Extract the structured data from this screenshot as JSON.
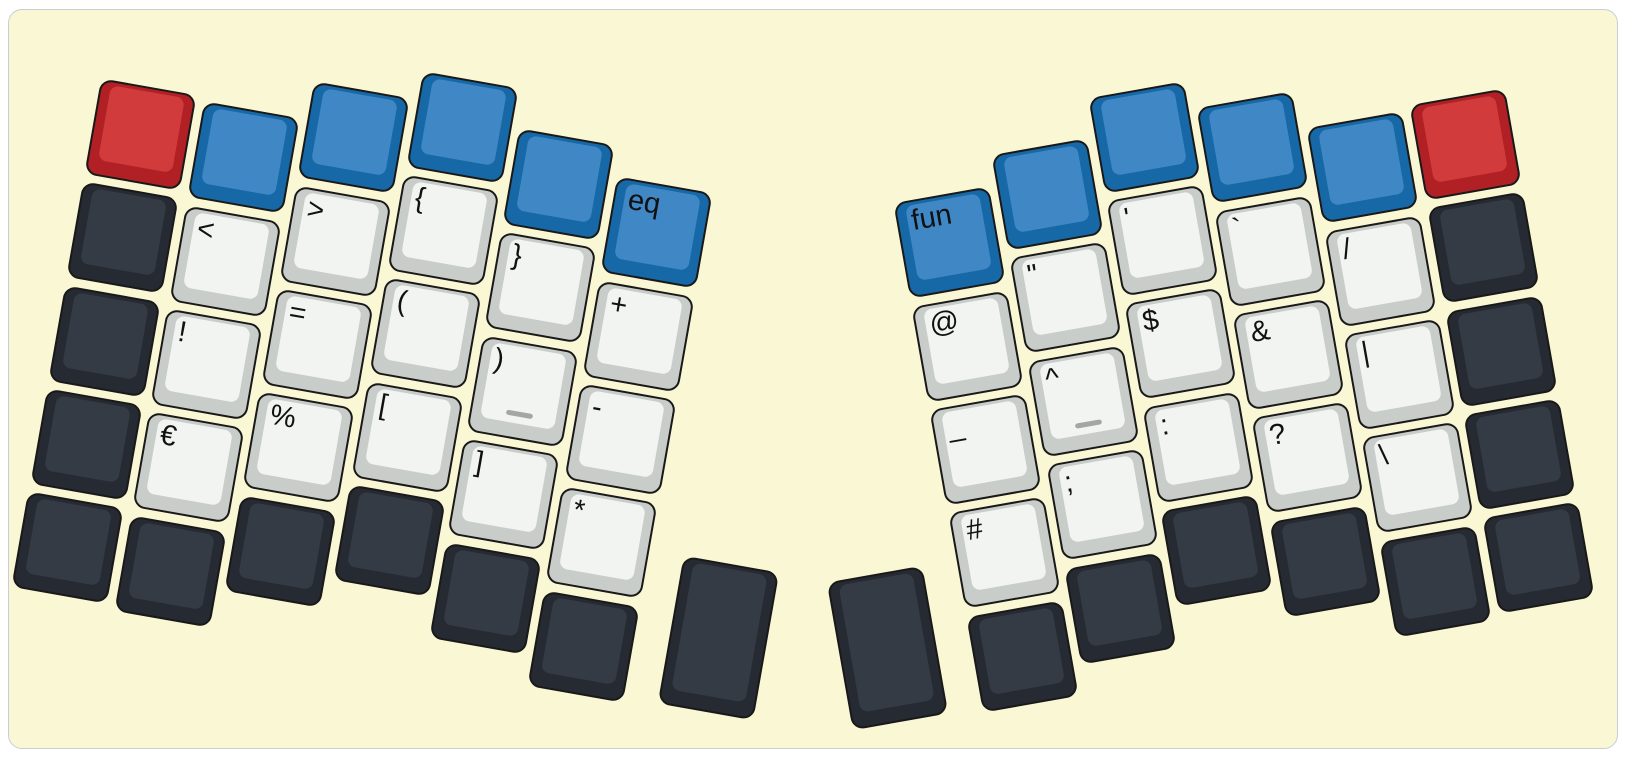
{
  "page": {
    "background": "#FFFFFF"
  },
  "panel": {
    "background": "#FAF7D4",
    "border_color": "#C7CED6"
  },
  "key_colors": {
    "red": {
      "base": "#B02025",
      "top": "#D23B3B"
    },
    "blue": {
      "base": "#1768A7",
      "top": "#3F87C5"
    },
    "dark": {
      "base": "#262A32",
      "top": "#353B45"
    },
    "light": {
      "base": "#C9CDC9",
      "top": "#F1F4F0"
    }
  },
  "outline_color": "#191919",
  "legend_color": "#111111",
  "homing_bar_color": "#A2A7A1",
  "geometry": {
    "pitch": 105,
    "key_size": 97,
    "legend_font_size": 29
  },
  "halves": [
    {
      "name": "left-half",
      "angle": 10,
      "origin": [
        462,
        127
      ],
      "anchor_col": 3,
      "staggers": [
        0.6,
        0.65,
        0.28,
        0,
        0.38,
        0.67
      ],
      "columns": [
        [
          {
            "c": "red",
            "n": "layer-red"
          },
          {
            "c": "dark"
          },
          {
            "c": "dark"
          },
          {
            "c": "dark"
          },
          {
            "c": "dark"
          }
        ],
        [
          {
            "c": "blue"
          },
          {
            "c": "light",
            "l": "<",
            "n": "less-than"
          },
          {
            "c": "light",
            "l": "!",
            "n": "exclamation"
          },
          {
            "c": "light",
            "l": "€",
            "n": "euro"
          },
          {
            "c": "dark"
          }
        ],
        [
          {
            "c": "blue"
          },
          {
            "c": "light",
            "l": ">",
            "n": "greater-than"
          },
          {
            "c": "light",
            "l": "=",
            "n": "equals"
          },
          {
            "c": "light",
            "l": "%",
            "n": "percent"
          },
          {
            "c": "dark"
          }
        ],
        [
          {
            "c": "blue"
          },
          {
            "c": "light",
            "l": "{",
            "n": "brace-open"
          },
          {
            "c": "light",
            "l": "(",
            "n": "paren-open"
          },
          {
            "c": "light",
            "l": "[",
            "n": "bracket-open"
          },
          {
            "c": "dark"
          }
        ],
        [
          {
            "c": "blue"
          },
          {
            "c": "light",
            "l": "}",
            "n": "brace-close"
          },
          {
            "c": "light",
            "l": ")",
            "n": "paren-close",
            "bar": true
          },
          {
            "c": "light",
            "l": "]",
            "n": "bracket-close"
          },
          {
            "c": "dark"
          }
        ],
        [
          {
            "c": "blue",
            "l": "eq",
            "n": "layer-eq"
          },
          {
            "c": "light",
            "l": "+",
            "n": "plus"
          },
          {
            "c": "light",
            "l": "-",
            "n": "minus"
          },
          {
            "c": "light",
            "l": "*",
            "n": "asterisk"
          },
          {
            "c": "dark"
          }
        ]
      ],
      "thumb": {
        "x": 3.25,
        "y": 4.37,
        "w": 1,
        "h": 1.5,
        "key": {
          "c": "dark",
          "n": "thumb"
        }
      }
    },
    {
      "name": "right-half",
      "angle": -10,
      "origin": [
        1144,
        137
      ],
      "anchor_col": 2,
      "staggers": [
        0.67,
        0.38,
        0,
        0.28,
        0.65,
        0.6
      ],
      "columns": [
        [
          {
            "c": "blue",
            "l": "fun",
            "n": "layer-fun"
          },
          {
            "c": "light",
            "l": "@",
            "n": "at"
          },
          {
            "c": "light",
            "l": "_",
            "n": "underscore"
          },
          {
            "c": "light",
            "l": "#",
            "n": "hash"
          },
          {
            "c": "dark"
          }
        ],
        [
          {
            "c": "blue"
          },
          {
            "c": "light",
            "l": "\"",
            "n": "double-quote"
          },
          {
            "c": "light",
            "l": "^",
            "n": "caret",
            "bar": true
          },
          {
            "c": "light",
            "l": ";",
            "n": "semicolon"
          },
          {
            "c": "dark"
          }
        ],
        [
          {
            "c": "blue"
          },
          {
            "c": "light",
            "l": "'",
            "n": "apostrophe"
          },
          {
            "c": "light",
            "l": "$",
            "n": "dollar"
          },
          {
            "c": "light",
            "l": ":",
            "n": "colon"
          },
          {
            "c": "dark"
          }
        ],
        [
          {
            "c": "blue"
          },
          {
            "c": "light",
            "l": "`",
            "n": "backtick"
          },
          {
            "c": "light",
            "l": "&",
            "n": "ampersand"
          },
          {
            "c": "light",
            "l": "?",
            "n": "question"
          },
          {
            "c": "dark"
          }
        ],
        [
          {
            "c": "blue"
          },
          {
            "c": "light",
            "l": "/",
            "n": "slash"
          },
          {
            "c": "light",
            "l": "|",
            "n": "pipe"
          },
          {
            "c": "light",
            "l": "\\",
            "n": "backslash"
          },
          {
            "c": "dark"
          }
        ],
        [
          {
            "c": "red",
            "n": "layer-red"
          },
          {
            "c": "dark"
          },
          {
            "c": "dark"
          },
          {
            "c": "dark"
          },
          {
            "c": "dark"
          }
        ]
      ],
      "thumb": {
        "x": -3.25,
        "y": 4.37,
        "w": 1,
        "h": 1.5,
        "key": {
          "c": "dark",
          "n": "thumb"
        }
      }
    }
  ]
}
